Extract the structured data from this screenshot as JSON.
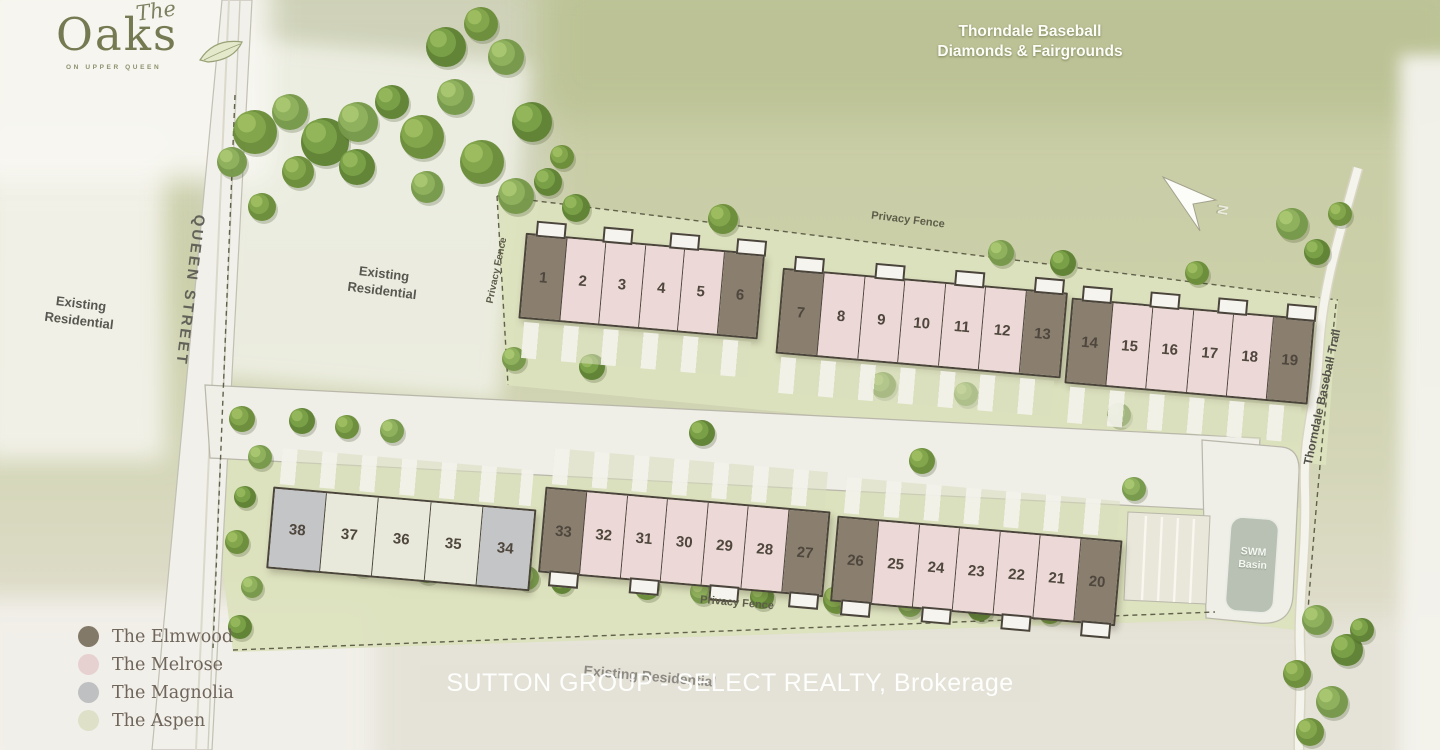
{
  "branding": {
    "script": "The",
    "name": "Oaks",
    "tagline": "ON UPPER QUEEN"
  },
  "labels": {
    "park": "Thorndale Baseball\nDiamonds & Fairgrounds",
    "queen_street": "QUEEN STREET",
    "existing_residential_left": "Existing\nResidential",
    "existing_residential_mid": "Existing\nResidential",
    "existing_residential_bottom": "Existing Residential",
    "privacy_fence": "Privacy Fence",
    "trail": "Thorndale Baseball Trail",
    "swm_basin": "SWM\nBasin",
    "north": "N",
    "watermark": "SUTTON GROUP - SELECT REALTY, Brokerage"
  },
  "models": {
    "elmwood": "#8a7f6f",
    "melrose": "#ecd8d7",
    "magnolia": "#c4c5c7",
    "aspen": "#e8e9da"
  },
  "legend": [
    {
      "label": "The Elmwood",
      "color": "#837968"
    },
    {
      "label": "The Melrose",
      "color": "#e7d1d0"
    },
    {
      "label": "The Magnolia",
      "color": "#bfc0c2"
    },
    {
      "label": "The Aspen",
      "color": "#dfe0c8"
    }
  ],
  "blocks": [
    {
      "id": "block-units-1-6",
      "units": [
        {
          "n": "1",
          "model": "elmwood"
        },
        {
          "n": "2",
          "model": "melrose"
        },
        {
          "n": "3",
          "model": "melrose"
        },
        {
          "n": "4",
          "model": "melrose"
        },
        {
          "n": "5",
          "model": "melrose"
        },
        {
          "n": "6",
          "model": "elmwood"
        }
      ]
    },
    {
      "id": "block-units-7-13",
      "units": [
        {
          "n": "7",
          "model": "elmwood"
        },
        {
          "n": "8",
          "model": "melrose"
        },
        {
          "n": "9",
          "model": "melrose"
        },
        {
          "n": "10",
          "model": "melrose"
        },
        {
          "n": "11",
          "model": "melrose"
        },
        {
          "n": "12",
          "model": "melrose"
        },
        {
          "n": "13",
          "model": "elmwood"
        }
      ]
    },
    {
      "id": "block-units-14-19",
      "units": [
        {
          "n": "14",
          "model": "elmwood"
        },
        {
          "n": "15",
          "model": "melrose"
        },
        {
          "n": "16",
          "model": "melrose"
        },
        {
          "n": "17",
          "model": "melrose"
        },
        {
          "n": "18",
          "model": "melrose"
        },
        {
          "n": "19",
          "model": "elmwood"
        }
      ]
    },
    {
      "id": "block-units-38-34",
      "units": [
        {
          "n": "38",
          "model": "magnolia"
        },
        {
          "n": "37",
          "model": "aspen"
        },
        {
          "n": "36",
          "model": "aspen"
        },
        {
          "n": "35",
          "model": "aspen"
        },
        {
          "n": "34",
          "model": "magnolia"
        }
      ]
    },
    {
      "id": "block-units-33-27",
      "units": [
        {
          "n": "33",
          "model": "elmwood"
        },
        {
          "n": "32",
          "model": "melrose"
        },
        {
          "n": "31",
          "model": "melrose"
        },
        {
          "n": "30",
          "model": "melrose"
        },
        {
          "n": "29",
          "model": "melrose"
        },
        {
          "n": "28",
          "model": "melrose"
        },
        {
          "n": "27",
          "model": "elmwood"
        }
      ]
    },
    {
      "id": "block-units-26-20",
      "units": [
        {
          "n": "26",
          "model": "elmwood"
        },
        {
          "n": "25",
          "model": "melrose"
        },
        {
          "n": "24",
          "model": "melrose"
        },
        {
          "n": "23",
          "model": "melrose"
        },
        {
          "n": "22",
          "model": "melrose"
        },
        {
          "n": "21",
          "model": "melrose"
        },
        {
          "n": "20",
          "model": "elmwood"
        }
      ]
    }
  ]
}
